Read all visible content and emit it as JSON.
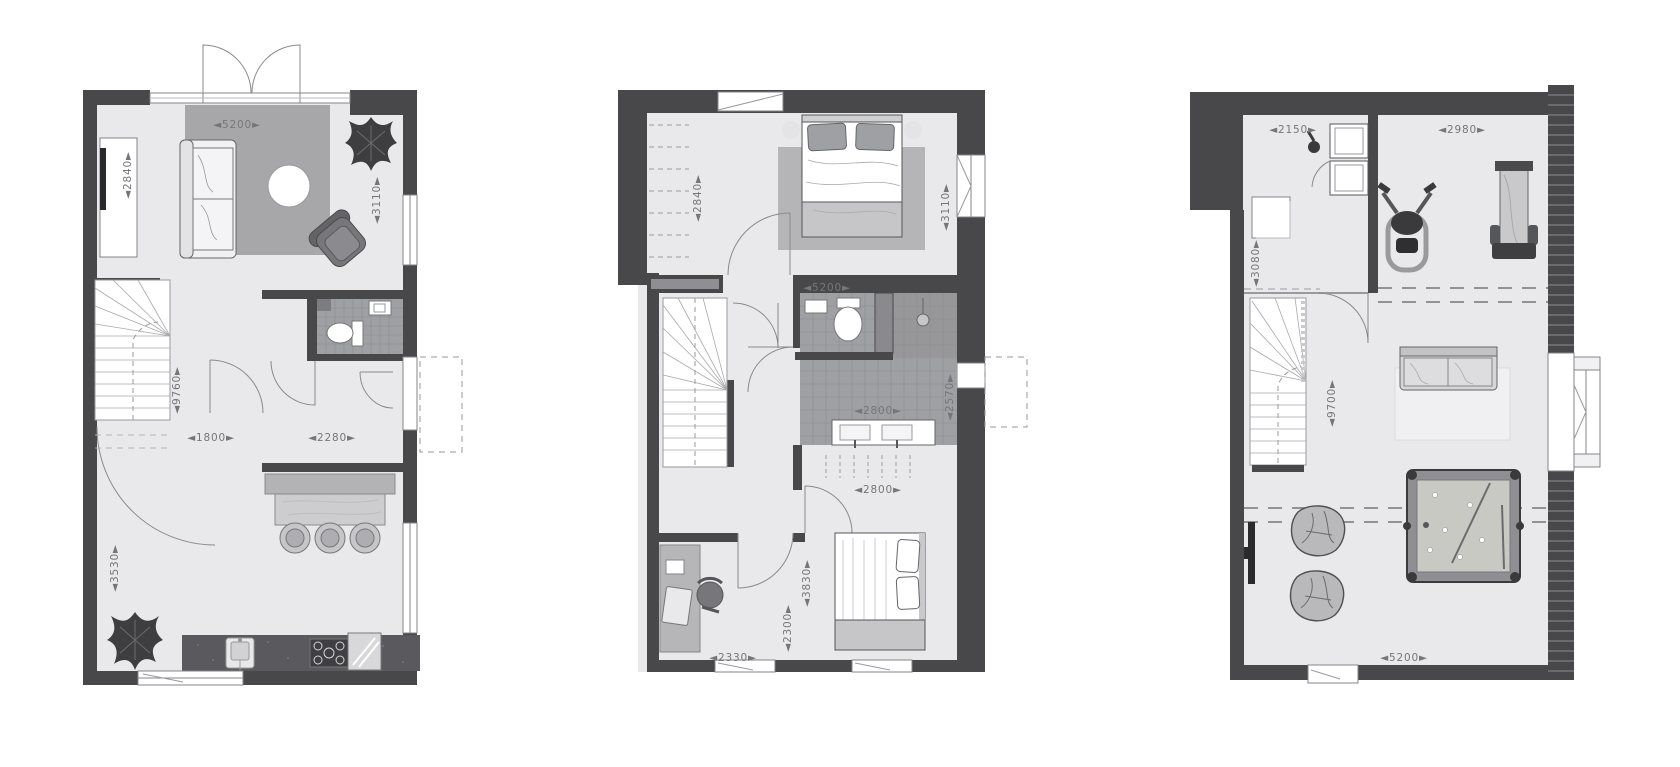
{
  "canvas": {
    "width": 1680,
    "height": 767,
    "background": "#ffffff"
  },
  "style": {
    "wall_color": "#48484b",
    "floor_color": "#e9e9eb",
    "tile_color": "#9fa0a3",
    "dim_text_color": "#76767a",
    "arrow_left": "◄",
    "arrow_right": "►"
  },
  "plans": [
    {
      "id": "ground-floor-plan",
      "box": {
        "left": 83,
        "top": 90,
        "width": 334,
        "height": 595
      },
      "furniture": [
        "sofa",
        "round-coffee-table",
        "armchair",
        "rug",
        "plant",
        "sideboard-tv",
        "winder-stairs",
        "toilet",
        "wc-sink",
        "kitchen-island",
        "bar-stools",
        "kitchen-counter",
        "kitchen-sink",
        "stove",
        "fridge",
        "french-doors",
        "entrance-canopy"
      ],
      "dimensions": [
        {
          "value": "5200",
          "orientation": "horizontal",
          "x": 154,
          "y": 35
        },
        {
          "value": "2840",
          "orientation": "vertical",
          "x": 45,
          "y": 85
        },
        {
          "value": "3110",
          "orientation": "vertical",
          "x": 294,
          "y": 110
        },
        {
          "value": "9760",
          "orientation": "vertical",
          "x": 94,
          "y": 300
        },
        {
          "value": "1800",
          "orientation": "horizontal",
          "x": 128,
          "y": 348
        },
        {
          "value": "2280",
          "orientation": "horizontal",
          "x": 249,
          "y": 348
        },
        {
          "value": "3530",
          "orientation": "vertical",
          "x": 32,
          "y": 478
        }
      ]
    },
    {
      "id": "first-floor-plan",
      "box": {
        "left": 618,
        "top": 90,
        "width": 367,
        "height": 590
      },
      "furniture": [
        "double-bed",
        "bedside-lamps",
        "rug",
        "wardrobe",
        "winder-stairs",
        "toilet",
        "shower",
        "double-vanity",
        "desk",
        "desk-chair",
        "laptop",
        "double-bed-2",
        "window-canopy"
      ],
      "dimensions": [
        {
          "value": "2840",
          "orientation": "vertical",
          "x": 80,
          "y": 108
        },
        {
          "value": "3110",
          "orientation": "vertical",
          "x": 328,
          "y": 117
        },
        {
          "value": "5200",
          "orientation": "horizontal",
          "x": 209,
          "y": 198
        },
        {
          "value": "2800",
          "orientation": "horizontal",
          "x": 260,
          "y": 321
        },
        {
          "value": "2570",
          "orientation": "vertical",
          "x": 332,
          "y": 307
        },
        {
          "value": "2800",
          "orientation": "horizontal",
          "x": 260,
          "y": 400
        },
        {
          "value": "3830",
          "orientation": "vertical",
          "x": 189,
          "y": 493
        },
        {
          "value": "2300",
          "orientation": "vertical",
          "x": 170,
          "y": 538
        },
        {
          "value": "2330",
          "orientation": "horizontal",
          "x": 115,
          "y": 568
        }
      ]
    },
    {
      "id": "attic-floor-plan",
      "box": {
        "left": 1190,
        "top": 85,
        "width": 422,
        "height": 600
      },
      "furniture": [
        "washer-dryer-stack",
        "iron",
        "side-table",
        "exercise-bike",
        "gym-bench",
        "winder-stairs",
        "sofa",
        "rug",
        "wall-tv",
        "pouf",
        "pouf",
        "pool-table",
        "dormer-window",
        "knee-wall-dashes"
      ],
      "dimensions": [
        {
          "value": "2150",
          "orientation": "horizontal",
          "x": 103,
          "y": 45
        },
        {
          "value": "2980",
          "orientation": "horizontal",
          "x": 272,
          "y": 45
        },
        {
          "value": "3080",
          "orientation": "vertical",
          "x": 66,
          "y": 178
        },
        {
          "value": "9700",
          "orientation": "vertical",
          "x": 142,
          "y": 318
        },
        {
          "value": "5200",
          "orientation": "horizontal",
          "x": 214,
          "y": 573
        }
      ]
    }
  ]
}
